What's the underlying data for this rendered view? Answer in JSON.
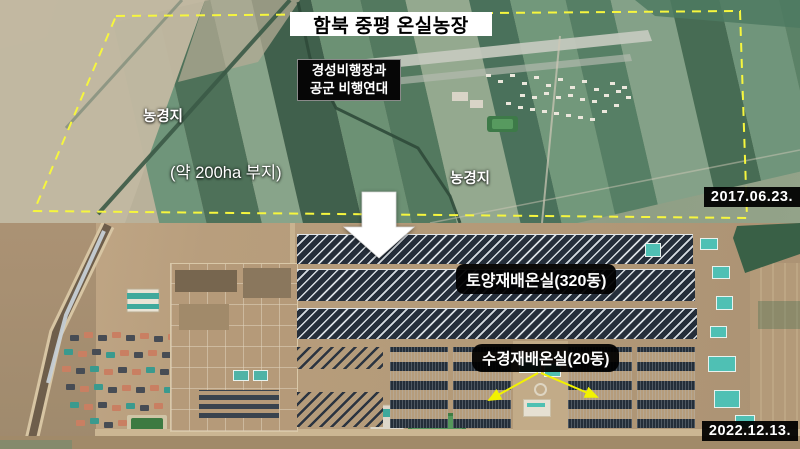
{
  "scene": {
    "title": "함북 중평 온실농장",
    "transition_icon": "down-arrow",
    "colors": {
      "boundary_dash": "#f6f63e",
      "annotation_arrow": "#f2f200",
      "transition_arrow": "#ffffff",
      "label_box_bg": "#000000",
      "label_text": "#ffffff",
      "title_bg": "#ffffff",
      "title_text": "#000000"
    }
  },
  "top_image": {
    "date": "2017.06.23.",
    "airfield_label": {
      "line1": "경성비행장과",
      "line2": "공군 비행연대"
    },
    "farmland_label_left": "농경지",
    "farmland_label_right": "농경지",
    "site_area_label": "(약 200ha 부지)"
  },
  "bottom_image": {
    "date": "2022.12.13.",
    "soil_greenhouse_label": "토양재배온실(320동)",
    "hydroponic_greenhouse_label": "수경재배온실(20동)"
  }
}
